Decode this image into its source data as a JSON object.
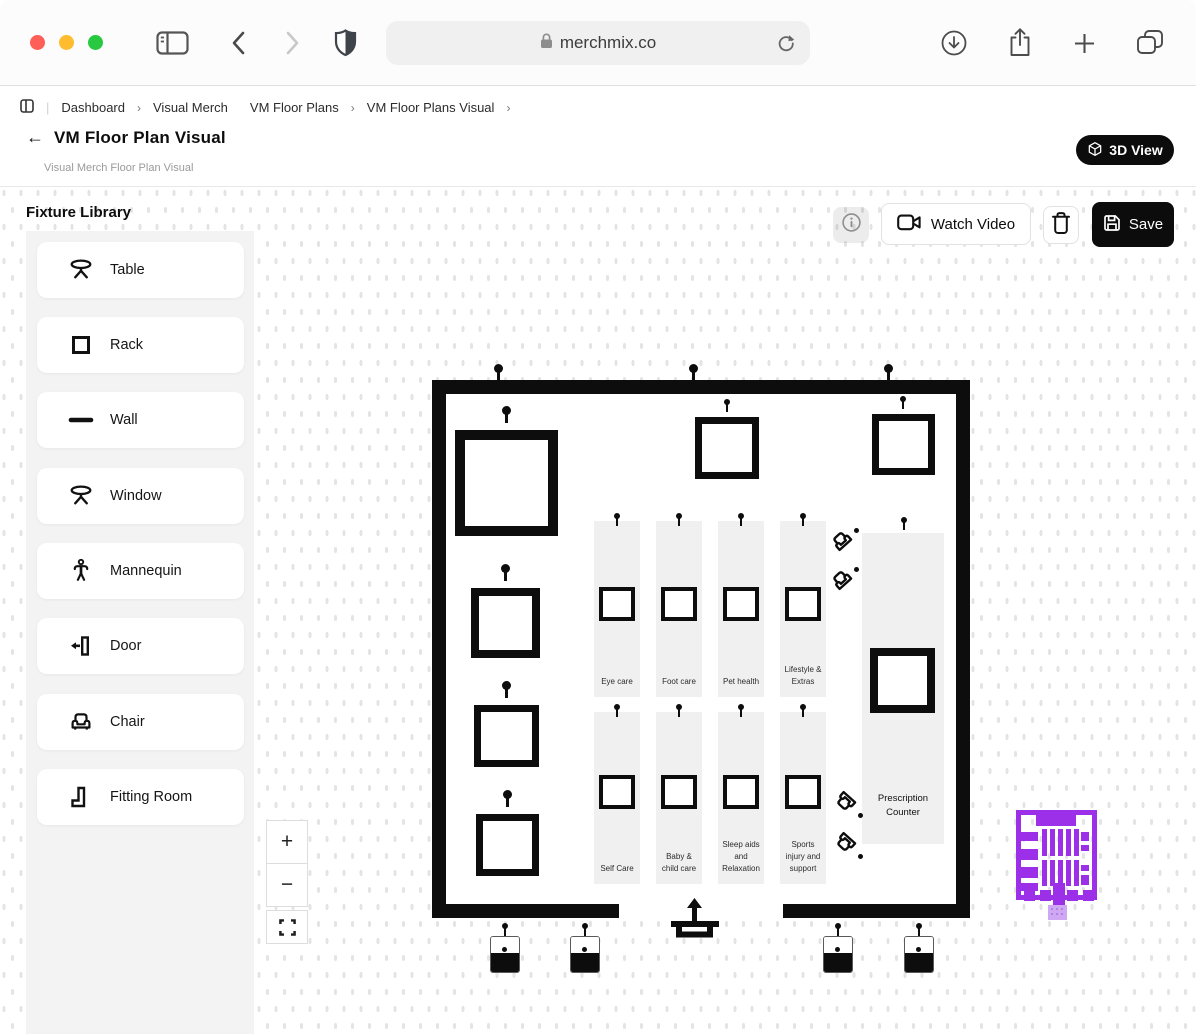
{
  "browser": {
    "url": "merchmix.co",
    "traffic_lights": {
      "close": "#FF5F57",
      "minimize": "#FEBC2E",
      "zoom": "#28C840"
    }
  },
  "breadcrumb": {
    "items": [
      "Dashboard",
      "Visual Merch",
      "VM Floor Plans",
      "VM Floor Plans Visual"
    ],
    "separator": "›"
  },
  "header": {
    "back_arrow": "←",
    "title": "VM Floor Plan Visual",
    "subtitle": "Visual Merch Floor Plan Visual",
    "view3d_label": "3D View"
  },
  "library": {
    "title": "Fixture Library",
    "items": [
      {
        "label": "Table",
        "icon": "table-icon"
      },
      {
        "label": "Rack",
        "icon": "rack-icon"
      },
      {
        "label": "Wall",
        "icon": "wall-icon"
      },
      {
        "label": "Window",
        "icon": "window-icon"
      },
      {
        "label": "Mannequin",
        "icon": "mannequin-icon"
      },
      {
        "label": "Door",
        "icon": "door-icon"
      },
      {
        "label": "Chair",
        "icon": "chair-icon"
      },
      {
        "label": "Fitting Room",
        "icon": "fitting-room-icon"
      }
    ]
  },
  "toolbar": {
    "watch_video": "Watch Video",
    "save": "Save"
  },
  "plan": {
    "aisles_top": [
      "Eye care",
      "Foot care",
      "Pet health",
      "Lifestyle & Extras"
    ],
    "aisles_bottom": [
      "Self Care",
      "Baby & child care",
      "Sleep aids and Relaxation",
      "Sports injury and support"
    ],
    "counter_label": "Prescription Counter"
  },
  "zoom_controls": {
    "zoom_in": "+",
    "zoom_out": "−"
  },
  "colors": {
    "accent_purple": "#9B30E8",
    "accent_purple_light": "#CFA7F3",
    "fixture_black": "#0D0D0D",
    "panel_gray": "#F3F3F3",
    "aisle_gray": "#F0F0F0"
  }
}
